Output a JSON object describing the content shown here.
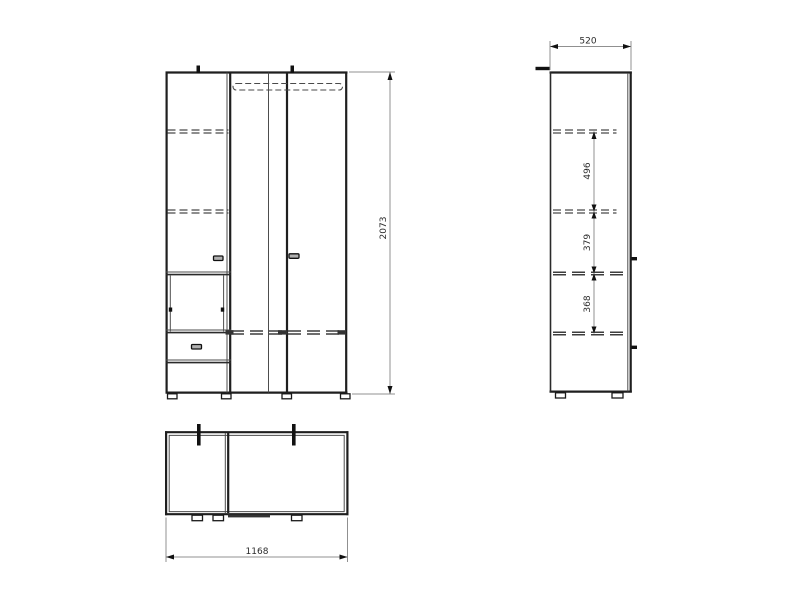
{
  "drawing": {
    "type": "furniture-orthographic-technical-drawing",
    "background_color": "#ffffff",
    "outline_color": "#1f1f1f",
    "hidden_line_color": "#4a4a4a",
    "dimension_line_color": "#909090",
    "dimension_text_color": "#2b2b2b",
    "dimensions": {
      "overall_height": "2073",
      "overall_depth": "520",
      "overall_width": "1168",
      "shelf_gap_top": "496",
      "shelf_gap_middle": "379",
      "shelf_gap_bottom": "368"
    },
    "views": {
      "front": {
        "height_label": "2073"
      },
      "side": {
        "depth_label": "520",
        "internal_labels": [
          "496",
          "379",
          "368"
        ]
      },
      "plan": {
        "width_label": "1168"
      }
    }
  }
}
